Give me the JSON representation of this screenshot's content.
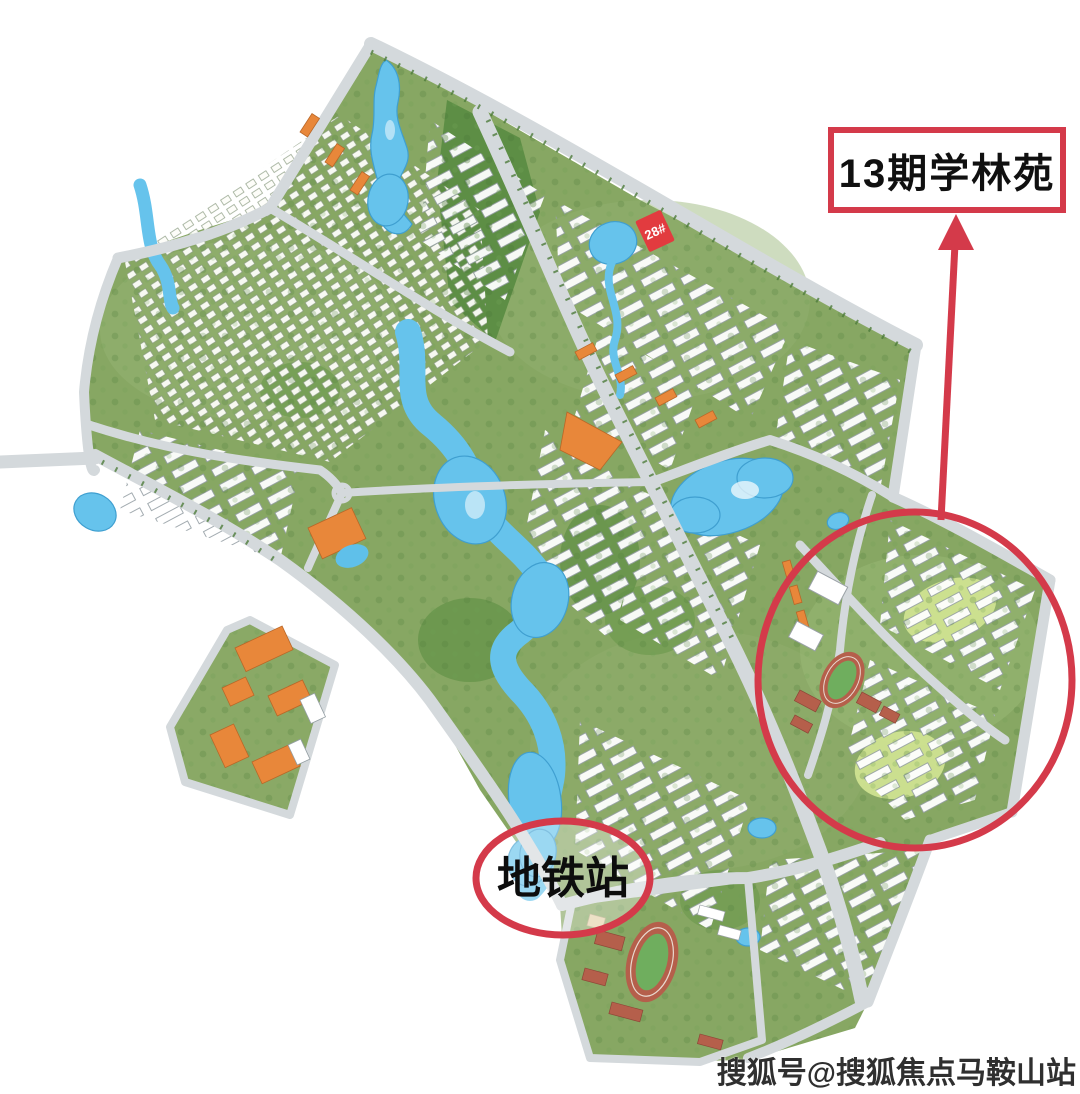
{
  "annotations": {
    "phase_label": "13期学林苑",
    "metro_label": "地铁站",
    "building_marker": "28#",
    "watermark": "搜狐号@搜狐焦点马鞍山站"
  },
  "map": {
    "type": "residential-masterplan-rendering",
    "highlighted_area": "13期学林苑"
  },
  "colors": {
    "annotation_red": "#d43a4a",
    "marker_red": "#e23b3f",
    "water_blue": "#66c3ec",
    "road_gray": "#d4d9dc",
    "green_base": "#87a763",
    "forest_green": "#5d8e45",
    "orange_building": "#e8873a",
    "campus_red": "#b55f4b",
    "lawn_yellow": "#d3e593"
  }
}
